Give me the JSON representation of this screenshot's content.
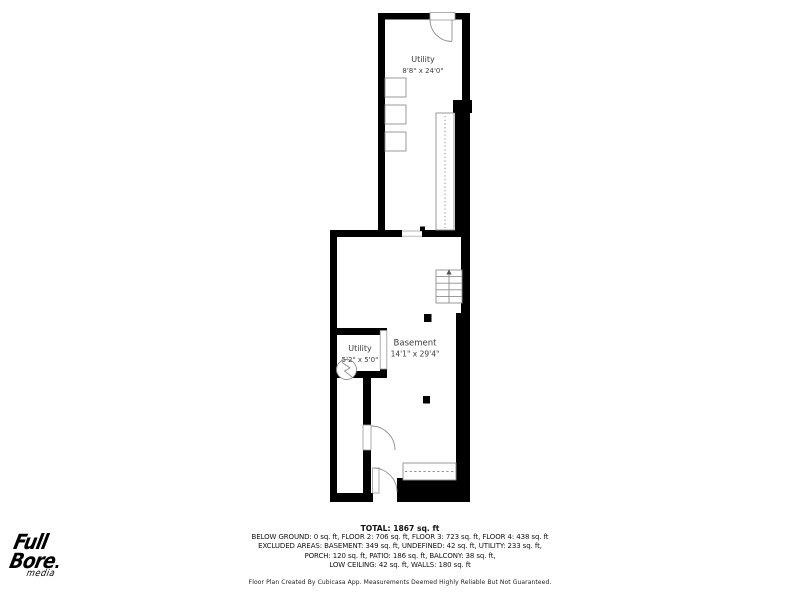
{
  "floor_plan": {
    "rooms": {
      "utility_upper": {
        "name": "Utility",
        "dimensions": "8'8\" x 24'0\""
      },
      "basement": {
        "name": "Basement",
        "dimensions": "14'1\" x 29'4\""
      },
      "utility_small": {
        "name": "Utility",
        "dimensions": "5'2\" x 5'0\""
      }
    },
    "icons": [
      "entry-door",
      "interior-door",
      "exterior-door",
      "staircase-upper",
      "staircase-basement",
      "staircase-bottom",
      "water-heater",
      "support-column",
      "appliance"
    ]
  },
  "summary": {
    "total": "TOTAL: 1867 sq. ft",
    "line1": "BELOW GROUND: 0 sq. ft, FLOOR 2: 706 sq. ft, FLOOR 3: 723 sq. ft, FLOOR 4: 438 sq. ft",
    "line2": "EXCLUDED AREAS: BASEMENT: 349 sq. ft, UNDEFINED: 42 sq. ft, UTILITY: 233 sq. ft,",
    "line3": "PORCH: 120 sq. ft, PATIO: 186 sq. ft, BALCONY: 38 sq. ft,",
    "line4": "LOW CEILING: 42 sq. ft, WALLS: 180 sq. ft",
    "disclaimer": "Floor Plan Created By Cubicasa App. Measurements Deemed Highly Reliable But Not Guaranteed."
  },
  "logo": {
    "line1": "Full",
    "line2": "Bore",
    "line3": "media"
  },
  "colors": {
    "wall": "#000000",
    "line": "#8f8f8f",
    "room_text": "#3d3d3d",
    "footer_text": "#111111",
    "bg": "#ffffff"
  }
}
